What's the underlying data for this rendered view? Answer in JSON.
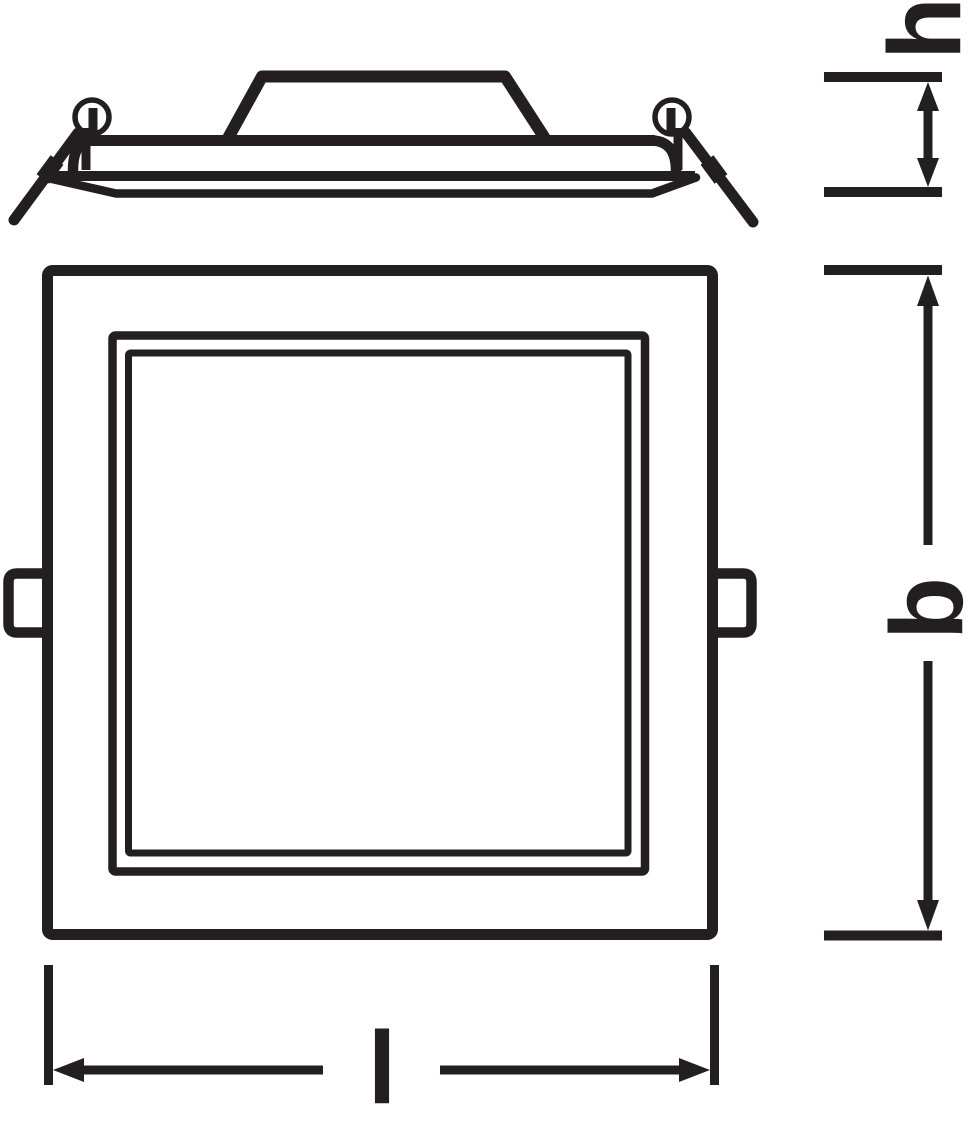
{
  "drawing": {
    "ink_color": "#231f20",
    "background_color": "#ffffff"
  },
  "dimensions": {
    "h": {
      "label": "h"
    },
    "b": {
      "label": "b"
    },
    "l": {
      "label": "l"
    }
  }
}
